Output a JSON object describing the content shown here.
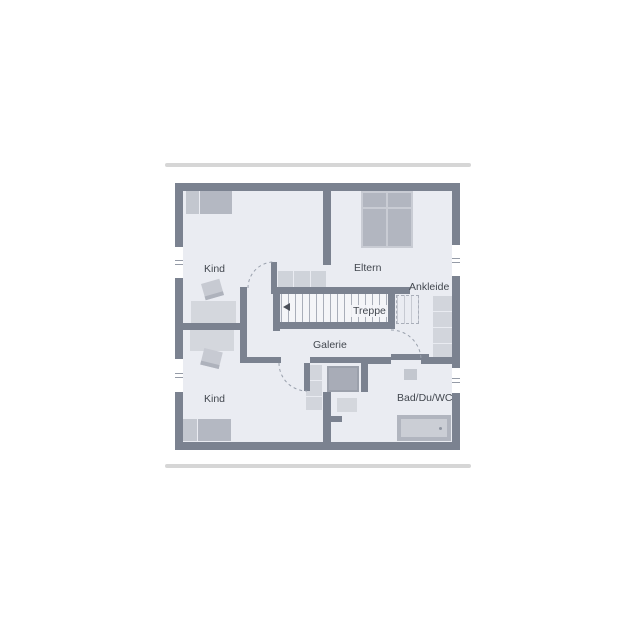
{
  "design": {
    "wall_color": "#7b8290",
    "floor_color": "#eaecf2",
    "accent_bar_color": "#d6d6d6",
    "furniture_light": "#d4d7dd",
    "furniture_medium": "#b4b8c2",
    "stair_background": "#f4f5f8"
  },
  "floorplan": {
    "rooms": [
      {
        "id": "kind-top",
        "label": "Kind"
      },
      {
        "id": "eltern",
        "label": "Eltern"
      },
      {
        "id": "ankleide",
        "label": "Ankleide"
      },
      {
        "id": "treppe",
        "label": "Treppe"
      },
      {
        "id": "galerie",
        "label": "Galerie"
      },
      {
        "id": "kind-bottom",
        "label": "Kind"
      },
      {
        "id": "bad",
        "label": "Bad/Du/WC"
      }
    ],
    "symbols": [
      "bed-single",
      "bed-double",
      "desk",
      "chair",
      "wardrobe",
      "shelf",
      "shower",
      "bathtub",
      "washbasin",
      "stairs",
      "window",
      "door-swing"
    ]
  }
}
